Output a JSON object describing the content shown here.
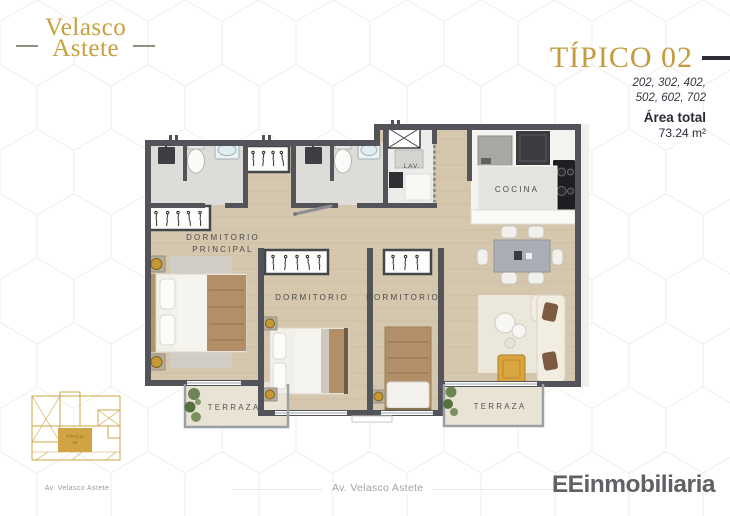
{
  "brand": {
    "name_line1": "Velasco",
    "name_line2": "Astete"
  },
  "plan_header": {
    "title": "TÍPICO 02",
    "units_line1": "202, 302, 402,",
    "units_line2": "502, 602, 702",
    "area_label": "Área total",
    "area_value": "73.24 m²"
  },
  "floorplan": {
    "labels": {
      "master_bedroom_line1": "DORMITORIO",
      "master_bedroom_line2": "PRINCIPAL",
      "bedroom_center": "DORMITORIO",
      "bedroom_right": "DORMITORIO",
      "kitchen": "COCINA",
      "laundry": "LAV.",
      "terrace_left": "TERRAZA",
      "terrace_right": "TERRAZA"
    }
  },
  "site_map": {
    "unit_label_line1": "TÍPICO",
    "unit_label_line2": "02",
    "caption": "Av. Velasco Astete"
  },
  "footer": {
    "street": "Av. Velasco Astete",
    "developer": "EEinmobiliaria"
  },
  "colors": {
    "brand_gold": "#c8a03c",
    "wall": "#53545a",
    "accent_dark": "#2b2e35"
  }
}
